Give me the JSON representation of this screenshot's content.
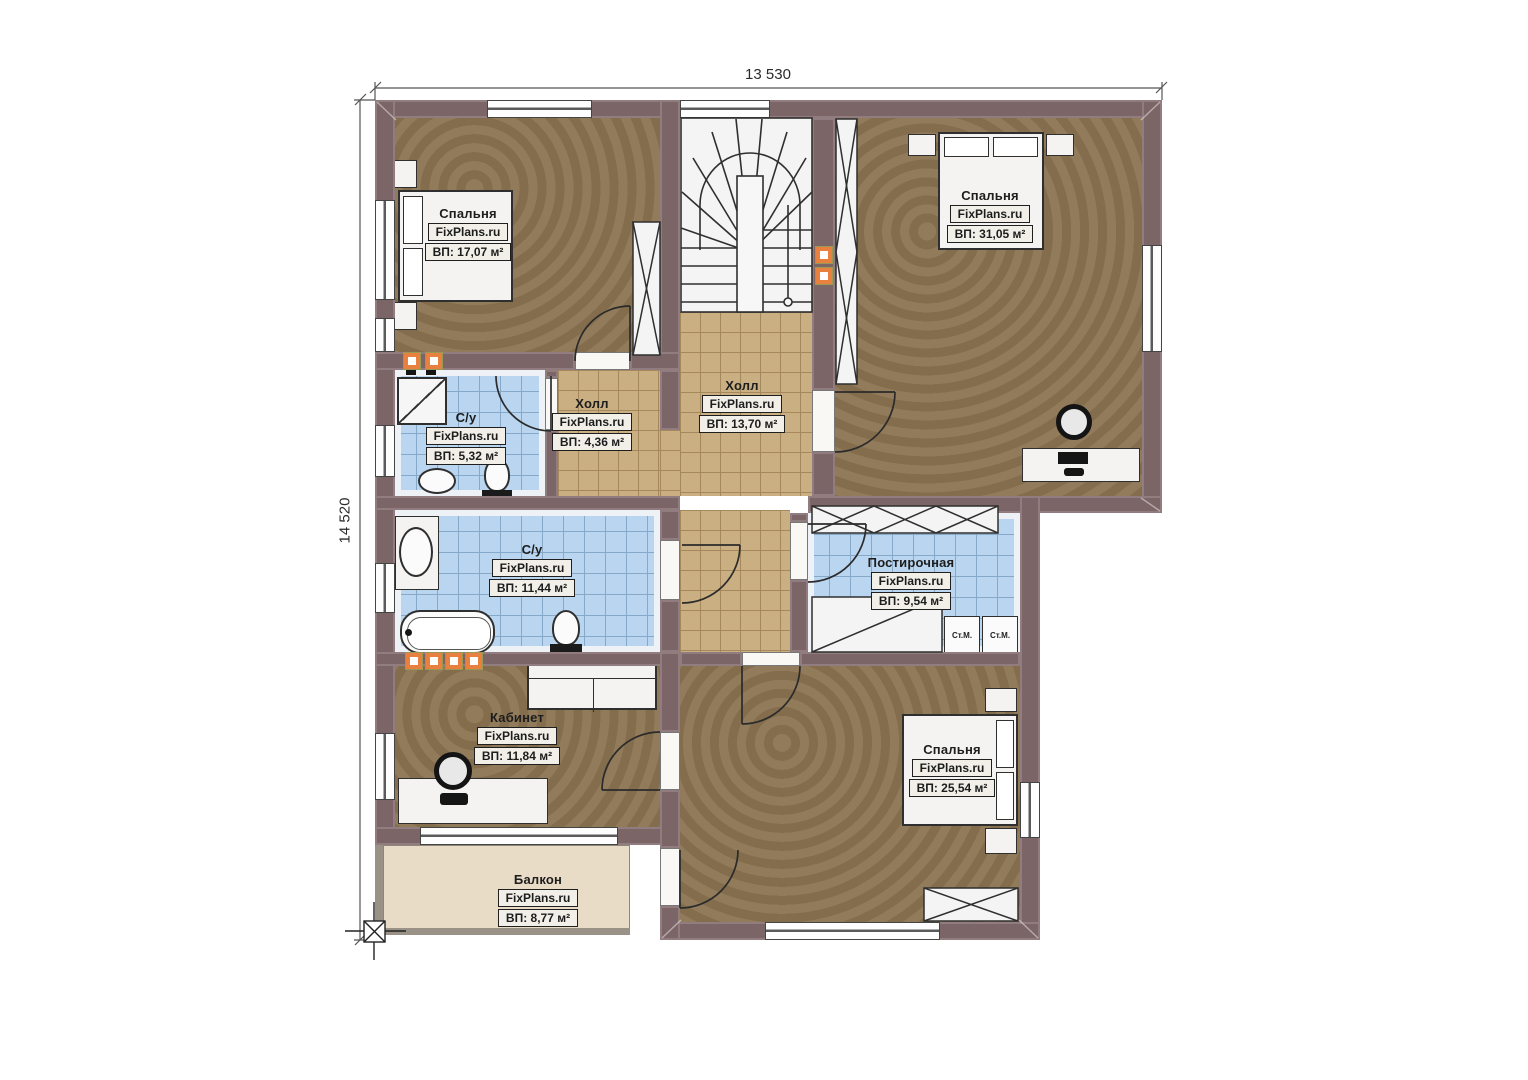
{
  "plan": {
    "title": "Second floor plan",
    "dimensions": {
      "top": "13 530",
      "left": "14 520"
    },
    "rooms": {
      "bedroom_top_left": {
        "name": "Спальня",
        "watermark": "FixPlans.ru",
        "area": "ВП: 17,07 м²"
      },
      "bedroom_top_right": {
        "name": "Спальня",
        "watermark": "FixPlans.ru",
        "area": "ВП: 31,05 м²"
      },
      "hall_small": {
        "name": "Холл",
        "watermark": "FixPlans.ru",
        "area": "ВП: 4,36 м²"
      },
      "hall_main": {
        "name": "Холл",
        "watermark": "FixPlans.ru",
        "area": "ВП: 13,70 м²"
      },
      "bathroom_small": {
        "name": "С/у",
        "watermark": "FixPlans.ru",
        "area": "ВП: 5,32 м²"
      },
      "bathroom_large": {
        "name": "С/у",
        "watermark": "FixPlans.ru",
        "area": "ВП: 11,44 м²"
      },
      "laundry": {
        "name": "Постирочная",
        "watermark": "FixPlans.ru",
        "area": "ВП: 9,54 м²"
      },
      "office": {
        "name": "Кабинет",
        "watermark": "FixPlans.ru",
        "area": "ВП: 11,84 м²"
      },
      "bedroom_bottom": {
        "name": "Спальня",
        "watermark": "FixPlans.ru",
        "area": "ВП: 25,54 м²"
      },
      "balcony": {
        "name": "Балкон",
        "watermark": "FixPlans.ru",
        "area": "ВП: 8,77 м²"
      }
    },
    "appliances": {
      "washer_left": "Ст.М.",
      "washer_right": "Ст.М."
    },
    "colors": {
      "wall": "#7c6567",
      "bedroom_floor": "#8b7452",
      "hall_tile": "#c9af81",
      "bath_tile": "#b9d5ef",
      "balcony_floor": "#e8dcc6",
      "accent_orange": "#e8803f"
    }
  }
}
